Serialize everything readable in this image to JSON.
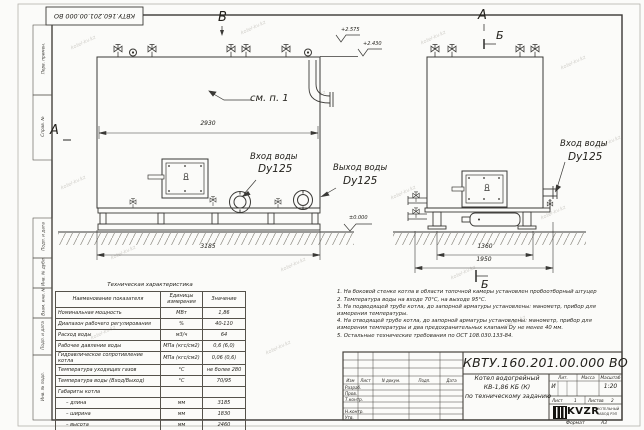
{
  "watermark": {
    "text": "kotel-kv.kz"
  },
  "frame": {
    "top_stamp": "КВТУ.160.201.00.000 ВО",
    "left_labels": [
      "Перв. примен.",
      "Справ. №",
      "Подп. и дата",
      "Инв. № дубл.",
      "Взам. инв. №",
      "Подп. и дата",
      "Инв. № подл."
    ],
    "format_label": "Формат",
    "format_value": "А3"
  },
  "views": {
    "front": {
      "marker_top": "В",
      "marker_left": "А",
      "see_note": "см. п. 1",
      "dim_top": "2930",
      "dim_base": "3185",
      "elev_valve": "+2.575",
      "elev_top": "+2.430",
      "elev_zero": "±0.000",
      "inlet_title": "Вход воды",
      "inlet_dn": "Dy125",
      "outlet_title": "Выход воды",
      "outlet_dn": "Dy125"
    },
    "side": {
      "marker_top": "А",
      "section_top": "Б",
      "section_bottom": "Б",
      "inlet_title": "Вход воды",
      "inlet_dn": "Dy125",
      "dim_feet": "1360",
      "dim_base": "1950"
    }
  },
  "spec_table": {
    "title": "Техническая характеристика",
    "headers": [
      "Наименование показателя",
      "Единицы измерения",
      "Значение"
    ],
    "rows": [
      {
        "name": "Номинальная мощность",
        "unit": "МВт",
        "value": "1,86"
      },
      {
        "name": "Диапазон рабочего регулирования",
        "unit": "%",
        "value": "40-110"
      },
      {
        "name": "Расход воды",
        "unit": "м3/ч",
        "value": "64"
      },
      {
        "name": "Рабочее давление воды",
        "unit": "МПа (кгс/см2)",
        "value": "0,6 (6,0)"
      },
      {
        "name": "Гидравлическое сопротивление котла",
        "unit": "МПа (кгс/см2)",
        "value": "0,06 (0,6)"
      },
      {
        "name": "Температура уходящих газов",
        "unit": "°С",
        "value": "не более 280"
      },
      {
        "name": "Температура воды (Вход/Выход)",
        "unit": "°С",
        "value": "70/95"
      },
      {
        "name": "Габариты котла",
        "unit": "",
        "value": ""
      },
      {
        "name": "– длина",
        "unit": "мм",
        "value": "3185"
      },
      {
        "name": "– ширина",
        "unit": "мм",
        "value": "1830"
      },
      {
        "name": "– высота",
        "unit": "мм",
        "value": "2460"
      }
    ]
  },
  "notes": {
    "items": [
      "1.  На боковой стенке котла в области топочной камеры установлен пробоотборный штуцер",
      "2.  Температура воды на входе 70°С, на выходе 95°С.",
      "3.  На подводящей трубе котла, до запорной арматуры установлены: манометр, прибор для измерения температуры.",
      "4.  На отводящей трубе котла, до запорной арматуры установлены: манометр, прибор для измерения температуры и два предохранительных клапана  Dу не менее 40 мм.",
      "5.  Остальные технические требования по ОСТ 108.030.133-84."
    ]
  },
  "title_block": {
    "designation": "КВТУ.160.201.00.000  ВО",
    "name_line1": "Котел водогрейный",
    "name_line2": "КВ-1,86 КБ (К)",
    "name_line3": "по техническому заданию",
    "col_izm": "Изм",
    "col_list": "Лист",
    "col_doc": "N докум.",
    "col_sign": "Подп.",
    "col_date": "Дата",
    "row_razrab": "Разраб.",
    "row_prov": "Пров.",
    "row_tkontr": "Т.контр.",
    "row_nkontr": "Н.контр.",
    "row_utv": "Утв.",
    "lit_label": "Лит.",
    "lit_value": "И",
    "mass_label": "Масса",
    "scale_label": "Масштаб",
    "scale_value": "1:20",
    "sheet_label": "Лист",
    "sheet_value": "1",
    "sheets_label": "Листов",
    "sheets_value": "2",
    "company_logo": "KVZR",
    "company_line1": "КОТЕЛЬНЫЙ",
    "company_line2": "ЗАВОД РЭП"
  }
}
